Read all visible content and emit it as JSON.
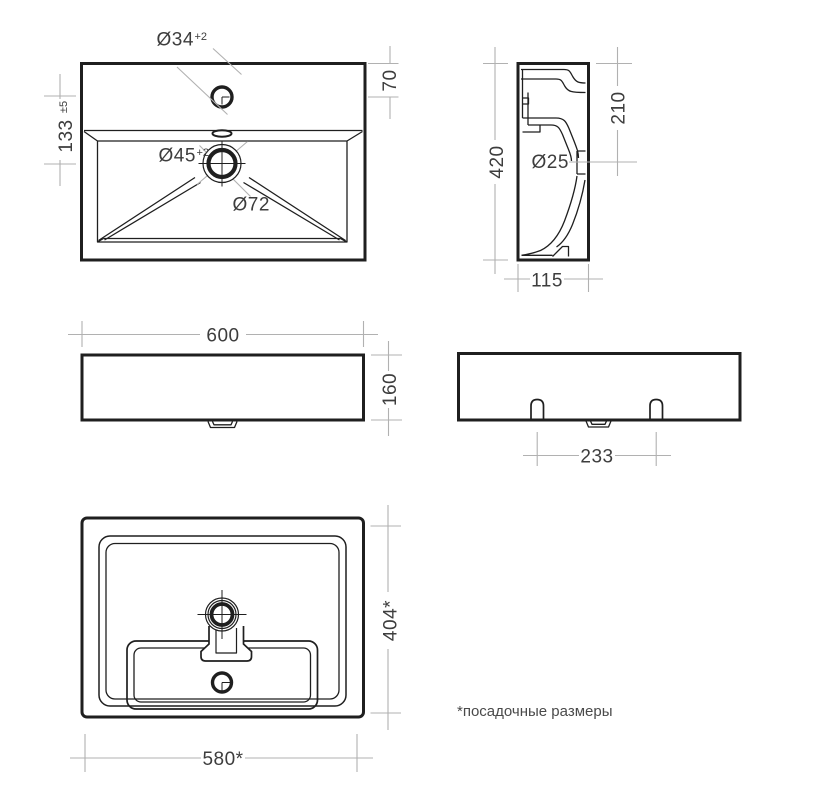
{
  "sheet": {
    "background": "#ffffff"
  },
  "colors": {
    "drawing_lines": "#1f1f1f",
    "dimension_lines": "#b1b1b1",
    "dimension_text": "#3d3d3d"
  },
  "views": {
    "plan": {
      "faucet_hole": {
        "diameter": "Ø34",
        "tolerance": "+2"
      },
      "drain_hole": {
        "diameter": "Ø45",
        "tolerance": "+2"
      },
      "drain_recess": {
        "diameter": "Ø72"
      },
      "edge_to_faucet": {
        "value": "70"
      },
      "faucet_to_drain": {
        "value": "133",
        "tolerance": "±5"
      }
    },
    "side": {
      "overall_height": {
        "value": "420"
      },
      "top_to_overflow": {
        "value": "210"
      },
      "overflow_hole": {
        "diameter": "Ø25"
      },
      "overall_depth": {
        "value": "115"
      }
    },
    "front": {
      "overall_width": {
        "value": "600"
      },
      "apron_height": {
        "value": "160"
      }
    },
    "back": {
      "mount_slot_spacing": {
        "value": "233"
      }
    },
    "bottom": {
      "mounting_depth": {
        "value": "404*"
      },
      "mounting_width": {
        "value": "580*"
      }
    }
  },
  "footnote": "*посадочные размеры"
}
